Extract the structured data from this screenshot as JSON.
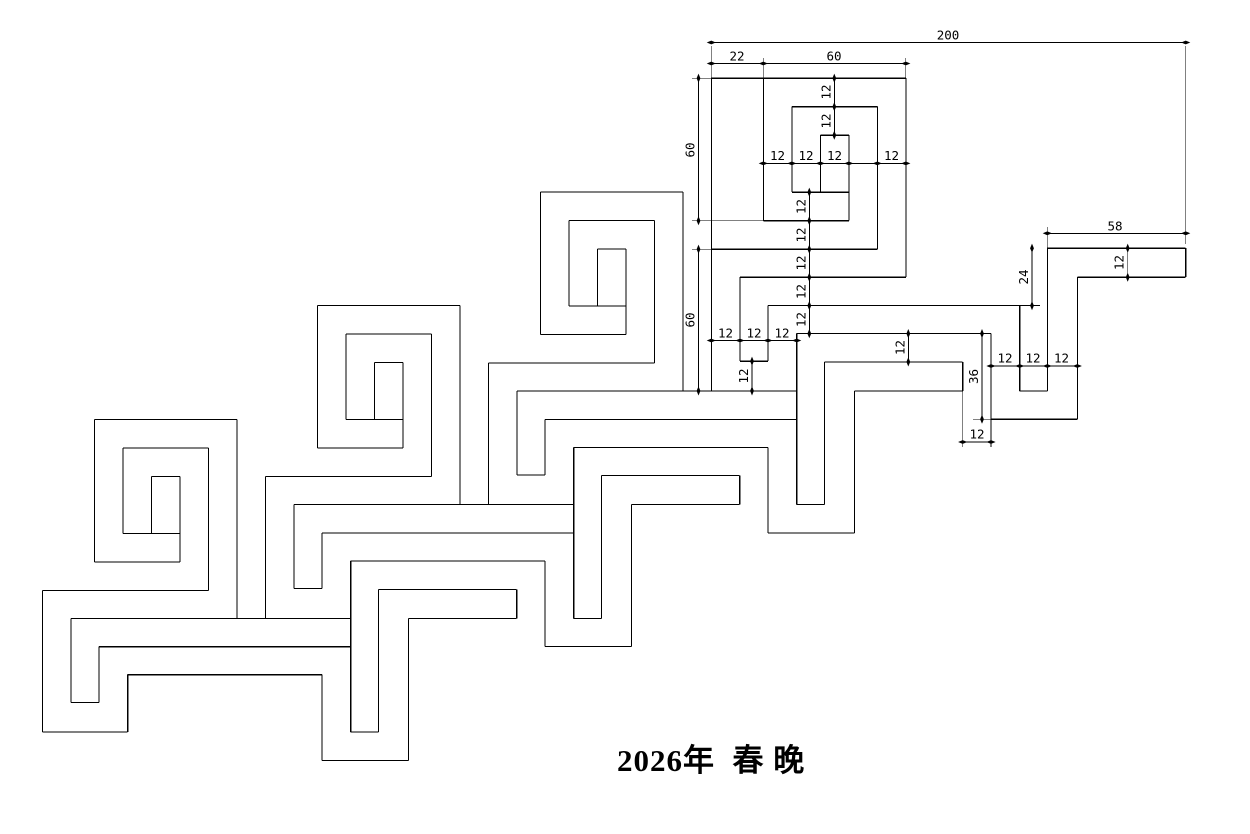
{
  "title": {
    "text": "2026年  春 晚"
  },
  "canvas": {
    "width": 1250,
    "height": 834,
    "background": "#ffffff",
    "line_color": "#000000"
  },
  "pattern_info": {
    "units": 4,
    "module": 12,
    "overall_width": 200,
    "spiral_size": 60,
    "left_gap": 22,
    "tail_length": 58,
    "tail_drop": 36,
    "tail_step": 24
  },
  "drawing": {
    "segments": [
      [
        94.3,
        419.3,
        236.8,
        419.3
      ],
      [
        122.8,
        447.8,
        208.3,
        447.8
      ],
      [
        151.3,
        476.3,
        179.8,
        476.3
      ],
      [
        122.8,
        533.3,
        179.8,
        533.3
      ],
      [
        94.3,
        561.8,
        179.8,
        561.8
      ],
      [
        94.3,
        419.3,
        94.3,
        561.8
      ],
      [
        122.8,
        447.8,
        122.8,
        533.3
      ],
      [
        151.3,
        476.3,
        151.3,
        533.3
      ],
      [
        179.8,
        476.3,
        179.8,
        561.8
      ],
      [
        208.3,
        447.8,
        208.3,
        590.3
      ],
      [
        236.8,
        419.3,
        236.8,
        618.3
      ],
      [
        42.3,
        590.3,
        208.3,
        590.3
      ],
      [
        71,
        618.3,
        265.3,
        618.3
      ],
      [
        42.3,
        590.3,
        42.3,
        732
      ],
      [
        42.3,
        732,
        127.7,
        732
      ],
      [
        127.7,
        674.7,
        127.7,
        732
      ],
      [
        127.7,
        674.7,
        322,
        674.7
      ],
      [
        322,
        674.7,
        322,
        760.3
      ],
      [
        322,
        760.3,
        408.3,
        760.3
      ],
      [
        408.3,
        618.3,
        408.3,
        760.3
      ],
      [
        408.3,
        618.3,
        516.7,
        618.3
      ],
      [
        516.7,
        589.3,
        516.7,
        618.3
      ],
      [
        378.3,
        589.3,
        516.7,
        589.3
      ],
      [
        378.3,
        589.3,
        378.3,
        732
      ],
      [
        350.7,
        732,
        378.3,
        732
      ],
      [
        350.7,
        561,
        350.7,
        732
      ],
      [
        71,
        618.3,
        71,
        702.3
      ],
      [
        71,
        702.3,
        99,
        702.3
      ],
      [
        99,
        646.7,
        99,
        702.3
      ],
      [
        99,
        646.7,
        350.7,
        646.7
      ],
      [
        317.3,
        305.6,
        459.8,
        305.6
      ],
      [
        345.8,
        334.1,
        431.3,
        334.1
      ],
      [
        374.3,
        362.6,
        402.8,
        362.6
      ],
      [
        345.8,
        419.6,
        402.8,
        419.6
      ],
      [
        317.3,
        448.1,
        402.8,
        448.1
      ],
      [
        317.3,
        305.6,
        317.3,
        448.1
      ],
      [
        345.8,
        334.1,
        345.8,
        419.6
      ],
      [
        374.3,
        362.6,
        374.3,
        419.6
      ],
      [
        402.8,
        362.6,
        402.8,
        448.1
      ],
      [
        431.3,
        334.1,
        431.3,
        476.6
      ],
      [
        459.8,
        305.6,
        459.8,
        504.6
      ],
      [
        265.3,
        476.6,
        431.3,
        476.6
      ],
      [
        294,
        504.6,
        488.3,
        504.6
      ],
      [
        265.3,
        476.6,
        265.3,
        618.3
      ],
      [
        265.3,
        618.3,
        350.7,
        618.3
      ],
      [
        350.7,
        561,
        545,
        561
      ],
      [
        545,
        561,
        545,
        646.6
      ],
      [
        545,
        646.6,
        631.3,
        646.6
      ],
      [
        631.3,
        504.6,
        631.3,
        646.6
      ],
      [
        631.3,
        504.6,
        739.7,
        504.6
      ],
      [
        739.7,
        475.6,
        739.7,
        504.6
      ],
      [
        601.3,
        475.6,
        739.7,
        475.6
      ],
      [
        601.3,
        475.6,
        601.3,
        618.3
      ],
      [
        573.7,
        618.3,
        601.3,
        618.3
      ],
      [
        573.7,
        447.3,
        573.7,
        618.3
      ],
      [
        294,
        504.6,
        294,
        588.6
      ],
      [
        294,
        588.6,
        322,
        588.6
      ],
      [
        322,
        533,
        322,
        588.6
      ],
      [
        322,
        533,
        573.7,
        533
      ],
      [
        540.3,
        191.9,
        682.8,
        191.9
      ],
      [
        568.8,
        220.4,
        654.3,
        220.4
      ],
      [
        597.3,
        248.9,
        625.8,
        248.9
      ],
      [
        568.8,
        305.9,
        625.8,
        305.9
      ],
      [
        540.3,
        334.4,
        625.8,
        334.4
      ],
      [
        540.3,
        191.9,
        540.3,
        334.4
      ],
      [
        568.8,
        220.4,
        568.8,
        305.9
      ],
      [
        597.3,
        248.9,
        597.3,
        305.9
      ],
      [
        625.8,
        248.9,
        625.8,
        334.4
      ],
      [
        654.3,
        220.4,
        654.3,
        362.9
      ],
      [
        682.8,
        191.9,
        682.8,
        390.9
      ],
      [
        488.3,
        362.9,
        654.3,
        362.9
      ],
      [
        517,
        390.9,
        711.3,
        390.9
      ],
      [
        488.3,
        362.9,
        488.3,
        504.6
      ],
      [
        488.3,
        504.6,
        573.7,
        504.6
      ],
      [
        573.7,
        447.3,
        768,
        447.3
      ],
      [
        768,
        447.3,
        768,
        532.9
      ],
      [
        768,
        532.9,
        854.3,
        532.9
      ],
      [
        854.3,
        390.9,
        854.3,
        532.9
      ],
      [
        854.3,
        390.9,
        962.7,
        390.9
      ],
      [
        962.7,
        361.9,
        962.7,
        390.9
      ],
      [
        824.3,
        361.9,
        962.7,
        361.9
      ],
      [
        824.3,
        361.9,
        824.3,
        504.6
      ],
      [
        796.7,
        504.6,
        824.3,
        504.6
      ],
      [
        796.7,
        333.6,
        796.7,
        504.6
      ],
      [
        517,
        390.9,
        517,
        474.9
      ],
      [
        517,
        474.9,
        545,
        474.9
      ],
      [
        545,
        419.3,
        545,
        474.9
      ],
      [
        545,
        419.3,
        796.7,
        419.3
      ],
      [
        763.3,
        78.2,
        905.8,
        78.2
      ],
      [
        791.8,
        106.7,
        877.3,
        106.7
      ],
      [
        820.3,
        135.2,
        848.8,
        135.2
      ],
      [
        791.8,
        192.2,
        848.8,
        192.2
      ],
      [
        763.3,
        220.7,
        848.8,
        220.7
      ],
      [
        763.3,
        78.2,
        763.3,
        220.7
      ],
      [
        791.8,
        106.7,
        791.8,
        192.2
      ],
      [
        820.3,
        135.2,
        820.3,
        192.2
      ],
      [
        848.8,
        135.2,
        848.8,
        220.7
      ],
      [
        877.3,
        106.7,
        877.3,
        249.2
      ],
      [
        905.8,
        78.2,
        905.8,
        277.2
      ],
      [
        711.3,
        249.2,
        877.3,
        249.2
      ],
      [
        740,
        277.2,
        905.8,
        277.2
      ],
      [
        711.3,
        78.2,
        711.3,
        390.9
      ],
      [
        711.3,
        390.9,
        796.7,
        390.9
      ],
      [
        796.7,
        333.6,
        991,
        333.6
      ],
      [
        991,
        333.6,
        991,
        419.2
      ],
      [
        991,
        419.2,
        1077.3,
        419.2
      ],
      [
        1077.3,
        277.2,
        1077.3,
        419.2
      ],
      [
        1077.3,
        277.2,
        1185.7,
        277.2
      ],
      [
        1185.7,
        248.2,
        1185.7,
        277.2
      ],
      [
        1047.3,
        248.2,
        1185.7,
        248.2
      ],
      [
        1047.3,
        248.2,
        1047.3,
        390.9
      ],
      [
        1019.7,
        390.9,
        1047.3,
        390.9
      ],
      [
        1019.7,
        305.6,
        1019.7,
        390.9
      ],
      [
        740,
        277.2,
        740,
        361.2
      ],
      [
        740,
        361.2,
        768,
        361.2
      ],
      [
        768,
        305.6,
        768,
        361.2
      ],
      [
        768,
        305.6,
        1019.7,
        305.6
      ],
      [
        711.3,
        78.2,
        763.3,
        78.2
      ]
    ],
    "dim_lines": [
      [
        711.3,
        42.5,
        1185.7,
        42.5
      ],
      [
        711.3,
        63.5,
        905.8,
        63.5
      ],
      [
        698.5,
        78.2,
        698.5,
        220.7
      ],
      [
        698.5,
        249.2,
        698.5,
        390.9
      ],
      [
        834.3,
        78.2,
        834.3,
        135.2
      ],
      [
        763.3,
        163.4,
        905.8,
        163.4
      ],
      [
        809.3,
        192.2,
        809.3,
        333.6
      ],
      [
        711.3,
        340.5,
        796.7,
        340.5
      ],
      [
        752,
        361.2,
        752,
        390.9
      ],
      [
        908.3,
        333.6,
        908.3,
        361.9
      ],
      [
        982,
        333.6,
        982,
        419.2
      ],
      [
        991,
        366,
        1077.3,
        366
      ],
      [
        962.7,
        442,
        991,
        442
      ],
      [
        1032,
        248.2,
        1032,
        305.6
      ],
      [
        1047.3,
        233.3,
        1185.7,
        233.3
      ],
      [
        1127.7,
        248.2,
        1127.7,
        277.2
      ]
    ],
    "ext_lines": [
      [
        711.3,
        46,
        711.3,
        78.2
      ],
      [
        1185.7,
        46,
        1185.7,
        244
      ],
      [
        763.3,
        58,
        763.3,
        78.2
      ],
      [
        905.8,
        58,
        905.8,
        78.2
      ],
      [
        692,
        78.2,
        711.3,
        78.2
      ],
      [
        692,
        220.7,
        763.3,
        220.7
      ],
      [
        692,
        249.2,
        711.3,
        249.2
      ],
      [
        692,
        390.9,
        711.3,
        390.9
      ],
      [
        1047.3,
        227,
        1047.3,
        248.2
      ],
      [
        1019.7,
        305.6,
        1040,
        305.6
      ],
      [
        973,
        419.2,
        991,
        419.2
      ],
      [
        962.7,
        390.9,
        962.7,
        447
      ],
      [
        991,
        419.2,
        991,
        447
      ]
    ],
    "ticks": [
      [
        711.3,
        42.5,
        0
      ],
      [
        1185.7,
        42.5,
        0
      ],
      [
        711.3,
        63.5,
        0
      ],
      [
        763.3,
        63.5,
        0
      ],
      [
        905.8,
        63.5,
        0
      ],
      [
        698.5,
        78.2,
        1
      ],
      [
        698.5,
        220.7,
        1
      ],
      [
        698.5,
        249.2,
        1
      ],
      [
        698.5,
        390.9,
        1
      ],
      [
        834.3,
        78.2,
        1
      ],
      [
        834.3,
        106.7,
        1
      ],
      [
        834.3,
        135.2,
        1
      ],
      [
        763.3,
        163.4,
        0
      ],
      [
        791.8,
        163.4,
        0
      ],
      [
        820.3,
        163.4,
        0
      ],
      [
        848.8,
        163.4,
        0
      ],
      [
        877.3,
        163.4,
        0
      ],
      [
        905.8,
        163.4,
        0
      ],
      [
        809.3,
        192.2,
        1
      ],
      [
        809.3,
        220.7,
        1
      ],
      [
        809.3,
        249.2,
        1
      ],
      [
        809.3,
        277.2,
        1
      ],
      [
        809.3,
        305.6,
        1
      ],
      [
        809.3,
        333.6,
        1
      ],
      [
        711.3,
        340.5,
        0
      ],
      [
        740,
        340.5,
        0
      ],
      [
        768,
        340.5,
        0
      ],
      [
        796.7,
        340.5,
        0
      ],
      [
        752,
        361.2,
        1
      ],
      [
        752,
        390.9,
        1
      ],
      [
        908.3,
        333.6,
        1
      ],
      [
        908.3,
        361.9,
        1
      ],
      [
        982,
        333.6,
        1
      ],
      [
        982,
        419.2,
        1
      ],
      [
        991,
        366,
        0
      ],
      [
        1019.7,
        366,
        0
      ],
      [
        1047.3,
        366,
        0
      ],
      [
        1077.3,
        366,
        0
      ],
      [
        962.7,
        442,
        0
      ],
      [
        991,
        442,
        0
      ],
      [
        1032,
        248.2,
        1
      ],
      [
        1032,
        305.6,
        1
      ],
      [
        1047.3,
        233.3,
        0
      ],
      [
        1185.7,
        233.3,
        0
      ],
      [
        1127.7,
        248.2,
        1
      ],
      [
        1127.7,
        277.2,
        1
      ]
    ],
    "labels": [
      {
        "t": "200",
        "x": 948,
        "y": 36,
        "r": 0
      },
      {
        "t": "22",
        "x": 737,
        "y": 57,
        "r": 0
      },
      {
        "t": "60",
        "x": 834,
        "y": 57,
        "r": 0
      },
      {
        "t": "60",
        "x": 691,
        "y": 150,
        "r": 1
      },
      {
        "t": "60",
        "x": 691,
        "y": 320,
        "r": 1
      },
      {
        "t": "12",
        "x": 827,
        "y": 92,
        "r": 1
      },
      {
        "t": "12",
        "x": 827,
        "y": 121,
        "r": 1
      },
      {
        "t": "12",
        "x": 777.5,
        "y": 156.5,
        "r": 0
      },
      {
        "t": "12",
        "x": 806,
        "y": 156.5,
        "r": 0
      },
      {
        "t": "12",
        "x": 834.5,
        "y": 156.5,
        "r": 0
      },
      {
        "t": "12",
        "x": 891.5,
        "y": 156.5,
        "r": 0
      },
      {
        "t": "12",
        "x": 802,
        "y": 206.5,
        "r": 1
      },
      {
        "t": "12",
        "x": 802,
        "y": 235,
        "r": 1
      },
      {
        "t": "12",
        "x": 802,
        "y": 263,
        "r": 1
      },
      {
        "t": "12",
        "x": 802,
        "y": 291.5,
        "r": 1
      },
      {
        "t": "12",
        "x": 802,
        "y": 319.5,
        "r": 1
      },
      {
        "t": "12",
        "x": 725.5,
        "y": 334,
        "r": 0
      },
      {
        "t": "12",
        "x": 754,
        "y": 334,
        "r": 0
      },
      {
        "t": "12",
        "x": 782,
        "y": 334,
        "r": 0
      },
      {
        "t": "12",
        "x": 744.5,
        "y": 376,
        "r": 1
      },
      {
        "t": "12",
        "x": 901,
        "y": 347.5,
        "r": 1
      },
      {
        "t": "36",
        "x": 974.5,
        "y": 376.5,
        "r": 1
      },
      {
        "t": "12",
        "x": 1005,
        "y": 359,
        "r": 0
      },
      {
        "t": "12",
        "x": 1033,
        "y": 359,
        "r": 0
      },
      {
        "t": "12",
        "x": 1061.5,
        "y": 359,
        "r": 0
      },
      {
        "t": "12",
        "x": 977,
        "y": 435,
        "r": 0
      },
      {
        "t": "24",
        "x": 1024.5,
        "y": 277,
        "r": 1
      },
      {
        "t": "58",
        "x": 1115,
        "y": 227,
        "r": 0
      },
      {
        "t": "12",
        "x": 1120,
        "y": 262.5,
        "r": 1
      }
    ]
  }
}
